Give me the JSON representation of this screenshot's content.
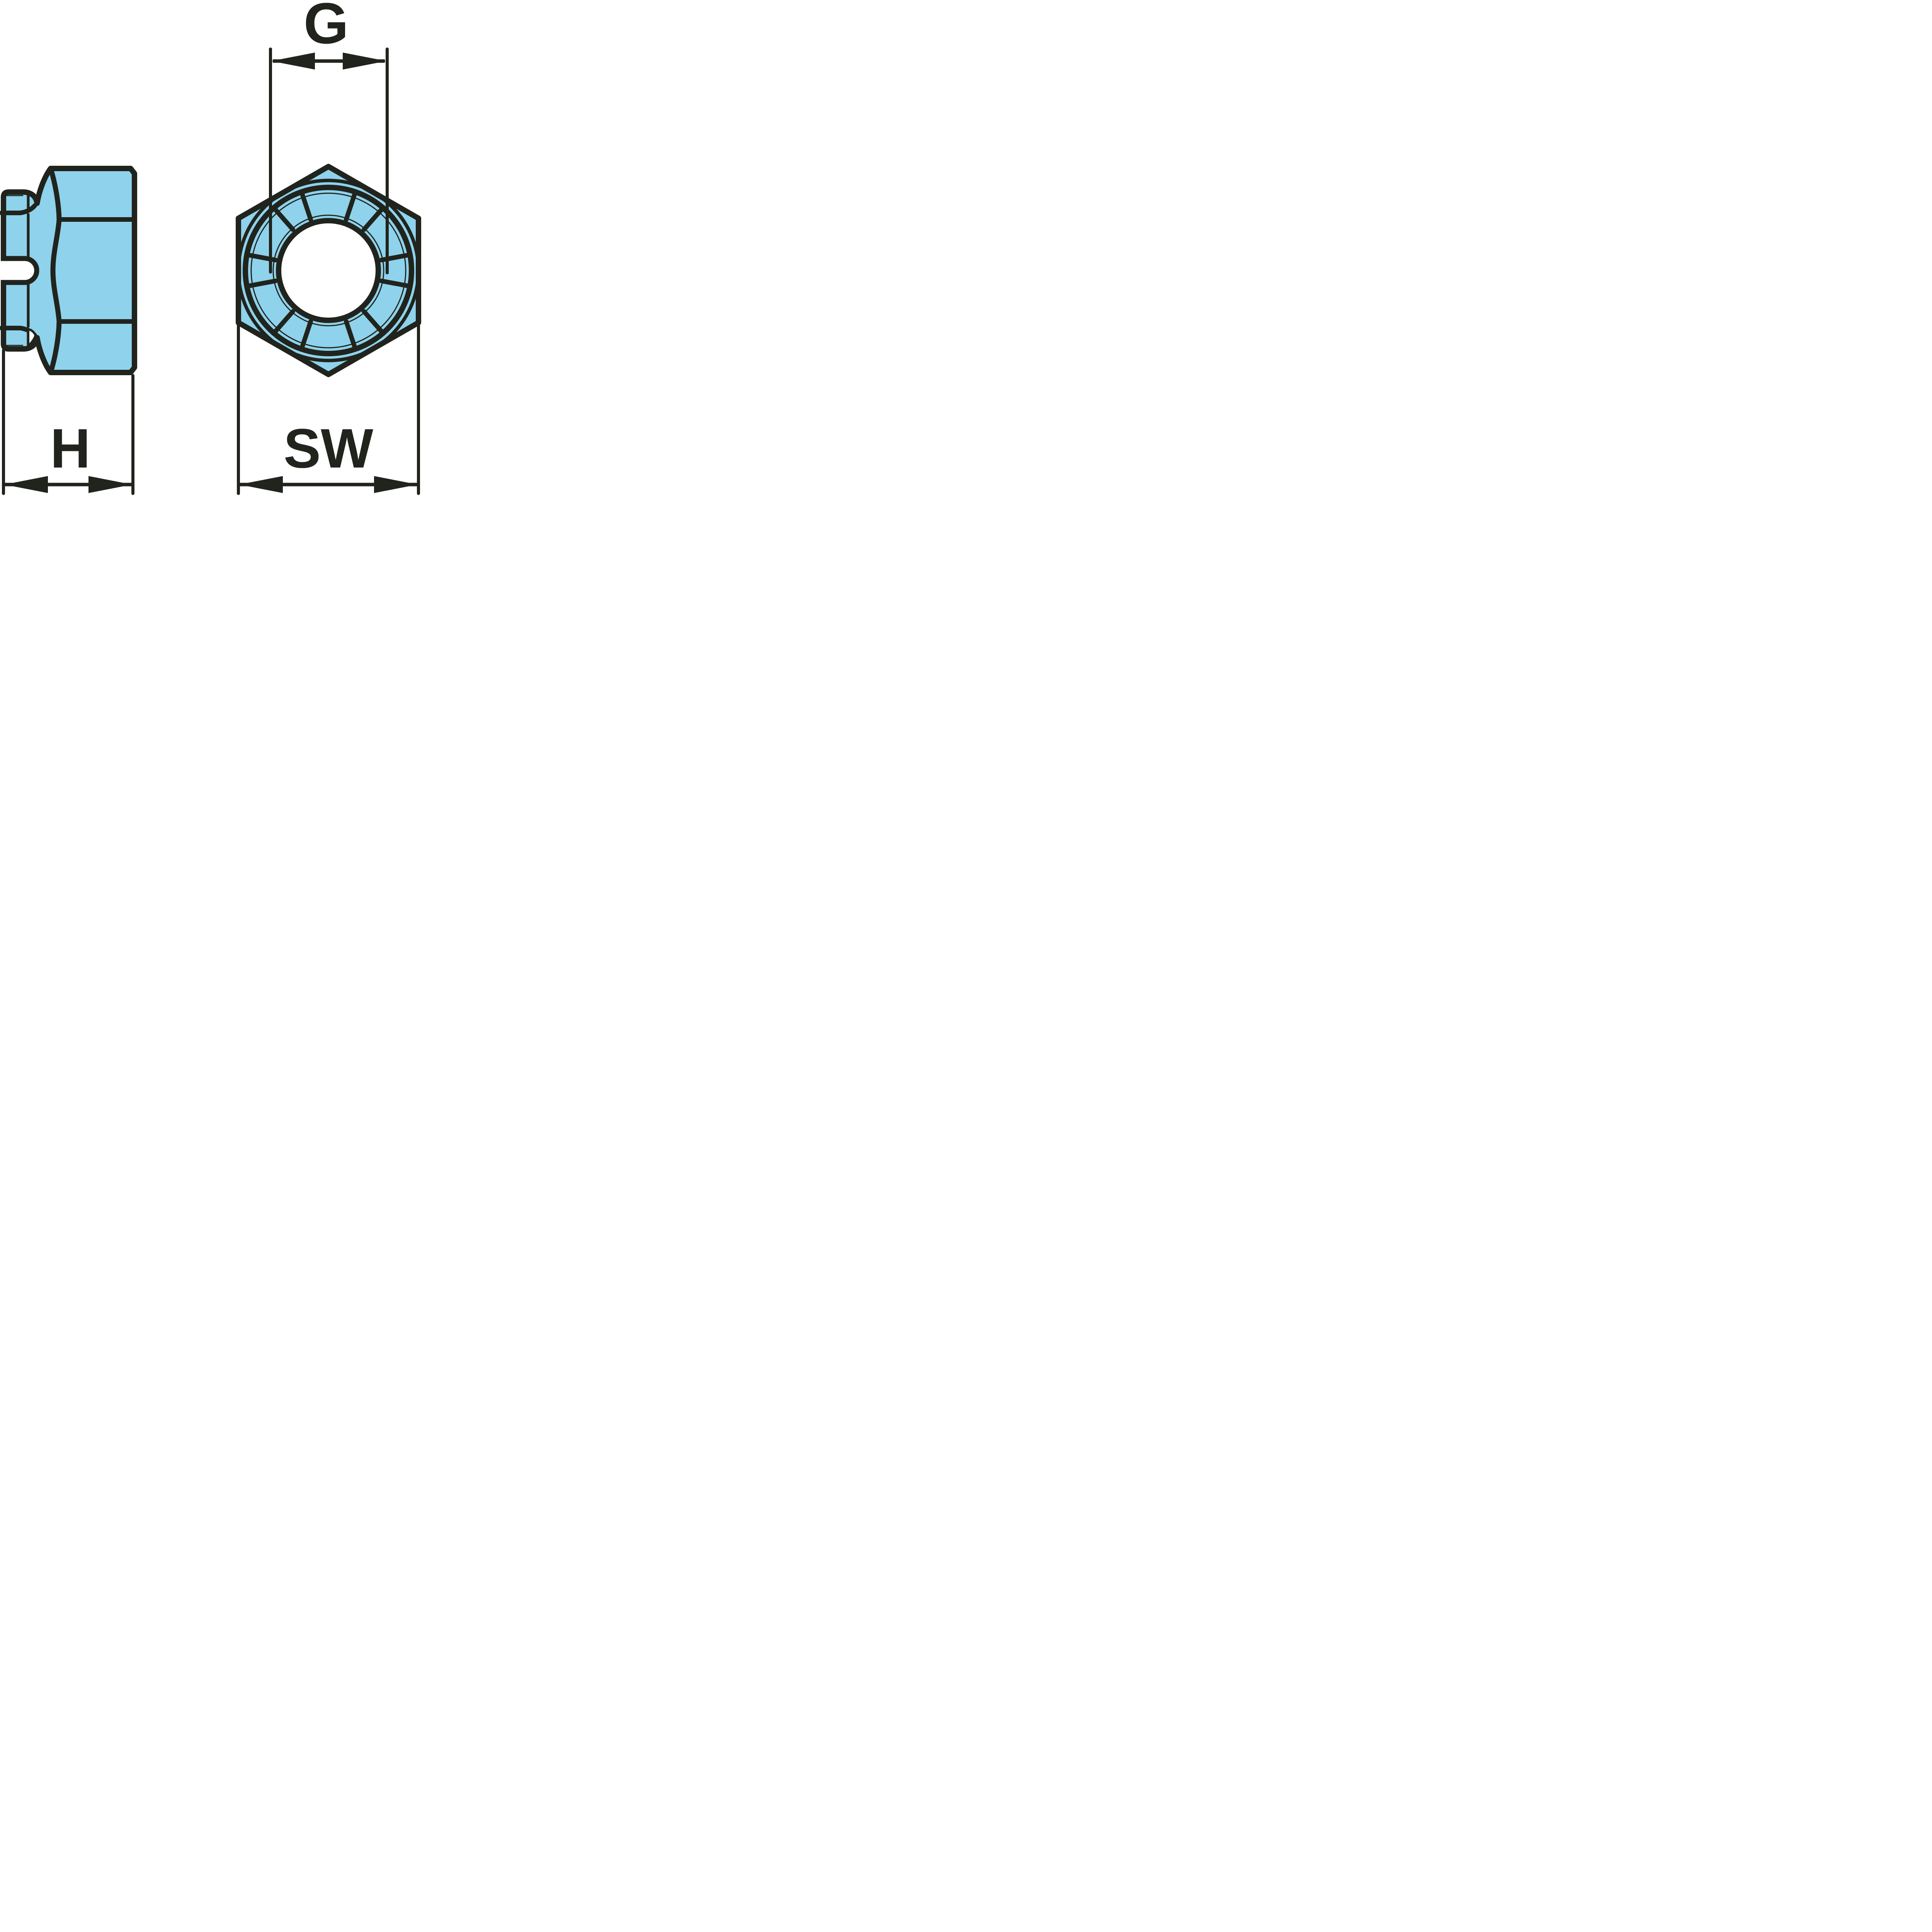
{
  "diagram": {
    "labels": {
      "g": "G",
      "h": "H",
      "sw": "SW"
    },
    "colors": {
      "line": "#20241d",
      "part_fill": "#8FD2EC",
      "background": "#FFFFFF"
    }
  }
}
